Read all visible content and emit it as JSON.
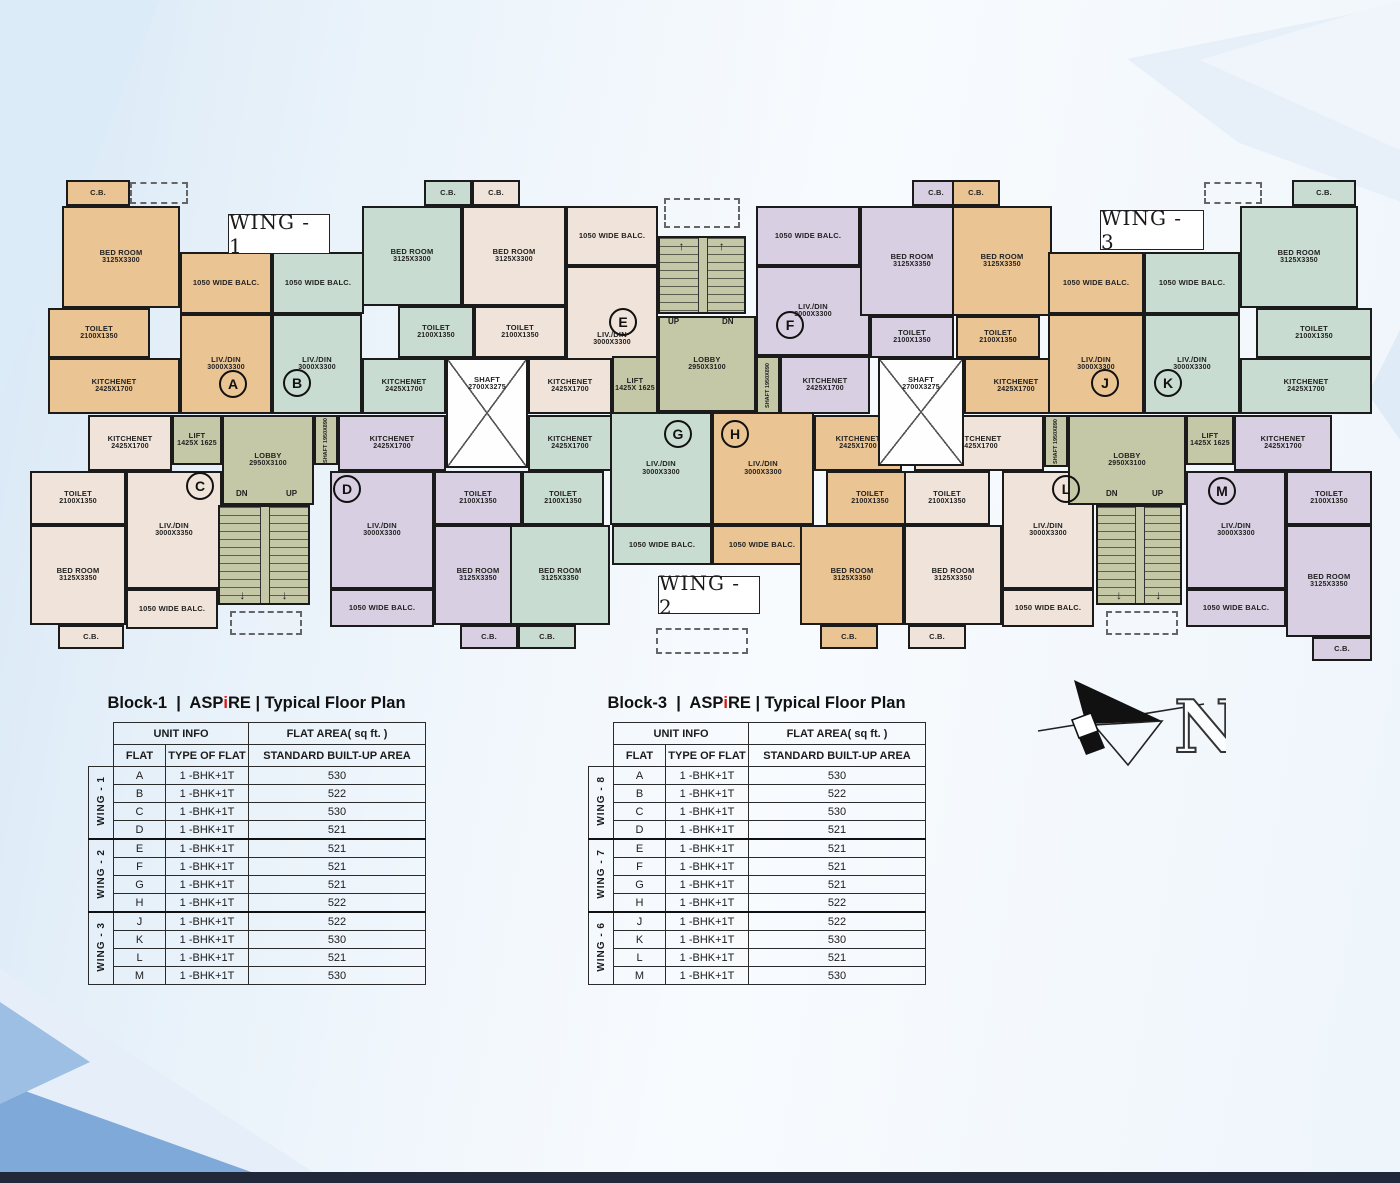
{
  "plan": {
    "wall_color": "#1b1b1b",
    "palette": {
      "tan": "#ebc493",
      "teal": "#c9dcd2",
      "cream": "#f0e3d9",
      "lav": "#d8d0e2",
      "core": "#c5c8a6",
      "shaft": "#fefefe"
    },
    "wings": [
      {
        "label": "WING - 1",
        "x": 228,
        "y": 214,
        "w": 102,
        "h": 40
      },
      {
        "label": "WING - 3",
        "x": 1100,
        "y": 210,
        "w": 104,
        "h": 40
      },
      {
        "label": "WING - 2",
        "x": 658,
        "y": 576,
        "w": 102,
        "h": 38
      }
    ],
    "rooms": [
      {
        "x": 66,
        "y": 180,
        "w": 64,
        "h": 26,
        "c": "tan",
        "n": "C.B.",
        "d": ""
      },
      {
        "x": 62,
        "y": 206,
        "w": 118,
        "h": 102,
        "c": "tan",
        "n": "BED ROOM",
        "d": "3125X3300"
      },
      {
        "x": 180,
        "y": 252,
        "w": 92,
        "h": 62,
        "c": "tan",
        "n": "1050 WIDE BALC.",
        "d": ""
      },
      {
        "x": 48,
        "y": 308,
        "w": 102,
        "h": 50,
        "c": "tan",
        "n": "TOILET",
        "d": "2100X1350"
      },
      {
        "x": 180,
        "y": 314,
        "w": 92,
        "h": 100,
        "c": "tan",
        "n": "LIV./DIN",
        "d": "3000X3300"
      },
      {
        "x": 48,
        "y": 358,
        "w": 132,
        "h": 56,
        "c": "tan",
        "n": "KITCHENET",
        "d": "2425X1700"
      },
      {
        "x": 272,
        "y": 252,
        "w": 92,
        "h": 62,
        "c": "teal",
        "n": "1050 WIDE BALC.",
        "d": ""
      },
      {
        "x": 272,
        "y": 314,
        "w": 90,
        "h": 100,
        "c": "teal",
        "n": "LIV./DIN",
        "d": "3000X3300"
      },
      {
        "x": 362,
        "y": 206,
        "w": 100,
        "h": 100,
        "c": "teal",
        "n": "BED ROOM",
        "d": "3125X3300"
      },
      {
        "x": 424,
        "y": 180,
        "w": 48,
        "h": 26,
        "c": "teal",
        "n": "C.B.",
        "d": ""
      },
      {
        "x": 398,
        "y": 306,
        "w": 76,
        "h": 52,
        "c": "teal",
        "n": "TOILET",
        "d": "2100X1350"
      },
      {
        "x": 362,
        "y": 358,
        "w": 84,
        "h": 56,
        "c": "teal",
        "n": "KITCHENET",
        "d": "2425X1700"
      },
      {
        "x": 472,
        "y": 180,
        "w": 48,
        "h": 26,
        "c": "cream",
        "n": "C.B.",
        "d": ""
      },
      {
        "x": 462,
        "y": 206,
        "w": 104,
        "h": 100,
        "c": "cream",
        "n": "BED ROOM",
        "d": "3125X3300"
      },
      {
        "x": 474,
        "y": 306,
        "w": 92,
        "h": 52,
        "c": "cream",
        "n": "TOILET",
        "d": "2100X1350"
      },
      {
        "x": 566,
        "y": 206,
        "w": 92,
        "h": 60,
        "c": "cream",
        "n": "1050 WIDE BALC.",
        "d": ""
      },
      {
        "x": 566,
        "y": 266,
        "w": 92,
        "h": 146,
        "c": "cream",
        "n": "LIV./DIN",
        "d": "3000X3300"
      },
      {
        "x": 528,
        "y": 358,
        "w": 84,
        "h": 56,
        "c": "cream",
        "n": "KITCHENET",
        "d": "2425X1700"
      },
      {
        "x": 612,
        "y": 356,
        "w": 46,
        "h": 58,
        "c": "core",
        "n": "LIFT",
        "d": "1425X 1625"
      },
      {
        "x": 658,
        "y": 316,
        "w": 98,
        "h": 96,
        "c": "core",
        "n": "LOBBY",
        "d": "2950X3100"
      },
      {
        "x": 756,
        "y": 206,
        "w": 104,
        "h": 60,
        "c": "lav",
        "n": "1050 WIDE BALC.",
        "d": ""
      },
      {
        "x": 756,
        "y": 266,
        "w": 114,
        "h": 90,
        "c": "lav",
        "n": "LIV./DIN",
        "d": "3000X3300"
      },
      {
        "x": 780,
        "y": 356,
        "w": 90,
        "h": 58,
        "c": "lav",
        "n": "KITCHENET",
        "d": "2425X1700"
      },
      {
        "x": 860,
        "y": 206,
        "w": 104,
        "h": 110,
        "c": "lav",
        "n": "BED ROOM",
        "d": "3125X3350"
      },
      {
        "x": 912,
        "y": 180,
        "w": 48,
        "h": 26,
        "c": "lav",
        "n": "C.B.",
        "d": ""
      },
      {
        "x": 870,
        "y": 316,
        "w": 84,
        "h": 42,
        "c": "lav",
        "n": "TOILET",
        "d": "2100X1350"
      },
      {
        "x": 952,
        "y": 180,
        "w": 48,
        "h": 26,
        "c": "tan",
        "n": "C.B.",
        "d": ""
      },
      {
        "x": 952,
        "y": 206,
        "w": 100,
        "h": 110,
        "c": "tan",
        "n": "BED ROOM",
        "d": "3125X3350"
      },
      {
        "x": 956,
        "y": 316,
        "w": 84,
        "h": 42,
        "c": "tan",
        "n": "TOILET",
        "d": "2100X1350"
      },
      {
        "x": 964,
        "y": 358,
        "w": 104,
        "h": 56,
        "c": "tan",
        "n": "KITCHENET",
        "d": "2425X1700"
      },
      {
        "x": 1048,
        "y": 252,
        "w": 96,
        "h": 62,
        "c": "tan",
        "n": "1050 WIDE BALC.",
        "d": ""
      },
      {
        "x": 1048,
        "y": 314,
        "w": 96,
        "h": 100,
        "c": "tan",
        "n": "LIV./DIN",
        "d": "3000X3300"
      },
      {
        "x": 1144,
        "y": 252,
        "w": 96,
        "h": 62,
        "c": "teal",
        "n": "1050 WIDE BALC.",
        "d": ""
      },
      {
        "x": 1144,
        "y": 314,
        "w": 96,
        "h": 100,
        "c": "teal",
        "n": "LIV./DIN",
        "d": "3000X3300"
      },
      {
        "x": 1240,
        "y": 206,
        "w": 118,
        "h": 102,
        "c": "teal",
        "n": "BED ROOM",
        "d": "3125X3350"
      },
      {
        "x": 1292,
        "y": 180,
        "w": 64,
        "h": 26,
        "c": "teal",
        "n": "C.B.",
        "d": ""
      },
      {
        "x": 1256,
        "y": 308,
        "w": 116,
        "h": 50,
        "c": "teal",
        "n": "TOILET",
        "d": "2100X1350"
      },
      {
        "x": 1240,
        "y": 358,
        "w": 132,
        "h": 56,
        "c": "teal",
        "n": "KITCHENET",
        "d": "2425X1700"
      },
      {
        "x": 88,
        "y": 415,
        "w": 84,
        "h": 56,
        "c": "cream",
        "n": "KITCHENET",
        "d": "2425X1700"
      },
      {
        "x": 172,
        "y": 415,
        "w": 50,
        "h": 50,
        "c": "core",
        "n": "LIFT",
        "d": "1425X 1625"
      },
      {
        "x": 222,
        "y": 415,
        "w": 92,
        "h": 90,
        "c": "core",
        "n": "LOBBY",
        "d": "2950X3100"
      },
      {
        "x": 30,
        "y": 471,
        "w": 96,
        "h": 54,
        "c": "cream",
        "n": "TOILET",
        "d": "2100X1350"
      },
      {
        "x": 126,
        "y": 471,
        "w": 96,
        "h": 118,
        "c": "cream",
        "n": "LIV./DIN",
        "d": "3000X3350"
      },
      {
        "x": 30,
        "y": 525,
        "w": 96,
        "h": 100,
        "c": "cream",
        "n": "BED ROOM",
        "d": "3125X3350"
      },
      {
        "x": 126,
        "y": 589,
        "w": 92,
        "h": 40,
        "c": "cream",
        "n": "1050 WIDE BALC.",
        "d": ""
      },
      {
        "x": 58,
        "y": 625,
        "w": 66,
        "h": 24,
        "c": "cream",
        "n": "C.B.",
        "d": ""
      },
      {
        "x": 338,
        "y": 415,
        "w": 108,
        "h": 56,
        "c": "lav",
        "n": "KITCHENET",
        "d": "2425X1700"
      },
      {
        "x": 330,
        "y": 471,
        "w": 104,
        "h": 118,
        "c": "lav",
        "n": "LIV./DIN",
        "d": "3000X3300"
      },
      {
        "x": 434,
        "y": 471,
        "w": 88,
        "h": 54,
        "c": "lav",
        "n": "TOILET",
        "d": "2100X1350"
      },
      {
        "x": 434,
        "y": 525,
        "w": 88,
        "h": 100,
        "c": "lav",
        "n": "BED ROOM",
        "d": "3125X3350"
      },
      {
        "x": 330,
        "y": 589,
        "w": 104,
        "h": 38,
        "c": "lav",
        "n": "1050 WIDE BALC.",
        "d": ""
      },
      {
        "x": 460,
        "y": 625,
        "w": 58,
        "h": 24,
        "c": "lav",
        "n": "C.B.",
        "d": ""
      },
      {
        "x": 528,
        "y": 415,
        "w": 84,
        "h": 56,
        "c": "teal",
        "n": "KITCHENET",
        "d": "2425X1700"
      },
      {
        "x": 522,
        "y": 471,
        "w": 82,
        "h": 54,
        "c": "teal",
        "n": "TOILET",
        "d": "2100X1350"
      },
      {
        "x": 510,
        "y": 525,
        "w": 100,
        "h": 100,
        "c": "teal",
        "n": "BED ROOM",
        "d": "3125X3350"
      },
      {
        "x": 518,
        "y": 625,
        "w": 58,
        "h": 24,
        "c": "teal",
        "n": "C.B.",
        "d": ""
      },
      {
        "x": 610,
        "y": 412,
        "w": 102,
        "h": 113,
        "c": "teal",
        "n": "LIV./DIN",
        "d": "3000X3300"
      },
      {
        "x": 612,
        "y": 525,
        "w": 100,
        "h": 40,
        "c": "teal",
        "n": "1050 WIDE BALC.",
        "d": ""
      },
      {
        "x": 712,
        "y": 412,
        "w": 102,
        "h": 113,
        "c": "tan",
        "n": "LIV./DIN",
        "d": "3000X3300"
      },
      {
        "x": 712,
        "y": 525,
        "w": 100,
        "h": 40,
        "c": "tan",
        "n": "1050 WIDE BALC.",
        "d": ""
      },
      {
        "x": 814,
        "y": 415,
        "w": 88,
        "h": 56,
        "c": "tan",
        "n": "KITCHENET",
        "d": "2425X1700"
      },
      {
        "x": 826,
        "y": 471,
        "w": 88,
        "h": 54,
        "c": "tan",
        "n": "TOILET",
        "d": "2100X1350"
      },
      {
        "x": 800,
        "y": 525,
        "w": 104,
        "h": 100,
        "c": "tan",
        "n": "BED ROOM",
        "d": "3125X3350"
      },
      {
        "x": 820,
        "y": 625,
        "w": 58,
        "h": 24,
        "c": "tan",
        "n": "C.B.",
        "d": ""
      },
      {
        "x": 914,
        "y": 415,
        "w": 130,
        "h": 56,
        "c": "cream",
        "n": "KITCHENET",
        "d": "2425X1700"
      },
      {
        "x": 904,
        "y": 471,
        "w": 86,
        "h": 54,
        "c": "cream",
        "n": "TOILET",
        "d": "2100X1350"
      },
      {
        "x": 904,
        "y": 525,
        "w": 98,
        "h": 100,
        "c": "cream",
        "n": "BED ROOM",
        "d": "3125X3350"
      },
      {
        "x": 908,
        "y": 625,
        "w": 58,
        "h": 24,
        "c": "cream",
        "n": "C.B.",
        "d": ""
      },
      {
        "x": 1002,
        "y": 471,
        "w": 92,
        "h": 118,
        "c": "cream",
        "n": "LIV./DIN",
        "d": "3000X3300"
      },
      {
        "x": 1002,
        "y": 589,
        "w": 92,
        "h": 38,
        "c": "cream",
        "n": "1050 WIDE BALC.",
        "d": ""
      },
      {
        "x": 1068,
        "y": 415,
        "w": 118,
        "h": 90,
        "c": "core",
        "n": "LOBBY",
        "d": "2950X3100"
      },
      {
        "x": 1186,
        "y": 415,
        "w": 48,
        "h": 50,
        "c": "core",
        "n": "LIFT",
        "d": "1425X 1625"
      },
      {
        "x": 1234,
        "y": 415,
        "w": 98,
        "h": 56,
        "c": "lav",
        "n": "KITCHENET",
        "d": "2425X1700"
      },
      {
        "x": 1186,
        "y": 471,
        "w": 100,
        "h": 118,
        "c": "lav",
        "n": "LIV./DIN",
        "d": "3000X3300"
      },
      {
        "x": 1186,
        "y": 589,
        "w": 100,
        "h": 38,
        "c": "lav",
        "n": "1050 WIDE BALC.",
        "d": ""
      },
      {
        "x": 1286,
        "y": 471,
        "w": 86,
        "h": 54,
        "c": "lav",
        "n": "TOILET",
        "d": "2100X1350"
      },
      {
        "x": 1286,
        "y": 525,
        "w": 86,
        "h": 112,
        "c": "lav",
        "n": "BED ROOM",
        "d": "3125X3350"
      },
      {
        "x": 1312,
        "y": 637,
        "w": 60,
        "h": 24,
        "c": "lav",
        "n": "C.B.",
        "d": ""
      }
    ],
    "shafts": [
      {
        "x": 446,
        "y": 358,
        "w": 82,
        "h": 110,
        "n": "SHAFT",
        "d": "2700X3275"
      },
      {
        "x": 878,
        "y": 358,
        "w": 86,
        "h": 108,
        "n": "SHAFT",
        "d": "2700X3275"
      }
    ],
    "vshafts": [
      {
        "x": 756,
        "y": 356,
        "w": 24,
        "h": 58,
        "t": "SHAFT 1950X890"
      },
      {
        "x": 314,
        "y": 415,
        "w": 24,
        "h": 50,
        "t": "SHAFT 1950X890"
      },
      {
        "x": 1044,
        "y": 415,
        "w": 24,
        "h": 52,
        "t": "SHAFT 1950X890"
      }
    ],
    "stairs": [
      {
        "x": 658,
        "y": 236,
        "w": 88,
        "h": 78,
        "arrow": "↑",
        "apos": "top"
      },
      {
        "x": 218,
        "y": 505,
        "w": 92,
        "h": 100,
        "arrow": "↓",
        "apos": "bottom"
      },
      {
        "x": 1096,
        "y": 505,
        "w": 86,
        "h": 100,
        "arrow": "↓",
        "apos": "bottom"
      }
    ],
    "texts": [
      {
        "t": "UP",
        "x": 668,
        "y": 317
      },
      {
        "t": "DN",
        "x": 722,
        "y": 317
      },
      {
        "t": "DN",
        "x": 236,
        "y": 489
      },
      {
        "t": "UP",
        "x": 286,
        "y": 489
      },
      {
        "t": "DN",
        "x": 1106,
        "y": 489
      },
      {
        "t": "UP",
        "x": 1152,
        "y": 489
      }
    ],
    "circles": [
      {
        "t": "A",
        "x": 233,
        "y": 384
      },
      {
        "t": "B",
        "x": 297,
        "y": 383
      },
      {
        "t": "C",
        "x": 200,
        "y": 486
      },
      {
        "t": "D",
        "x": 347,
        "y": 489
      },
      {
        "t": "E",
        "x": 623,
        "y": 322
      },
      {
        "t": "F",
        "x": 790,
        "y": 325
      },
      {
        "t": "G",
        "x": 678,
        "y": 434
      },
      {
        "t": "H",
        "x": 735,
        "y": 434
      },
      {
        "t": "J",
        "x": 1105,
        "y": 383
      },
      {
        "t": "K",
        "x": 1168,
        "y": 383
      },
      {
        "t": "L",
        "x": 1066,
        "y": 489
      },
      {
        "t": "M",
        "x": 1222,
        "y": 491
      }
    ],
    "dashed": [
      {
        "x": 656,
        "y": 628,
        "w": 92,
        "h": 26
      },
      {
        "x": 230,
        "y": 611,
        "w": 72,
        "h": 24
      },
      {
        "x": 1106,
        "y": 611,
        "w": 72,
        "h": 24
      },
      {
        "x": 664,
        "y": 198,
        "w": 76,
        "h": 30
      },
      {
        "x": 130,
        "y": 182,
        "w": 58,
        "h": 22
      },
      {
        "x": 1204,
        "y": 182,
        "w": 58,
        "h": 22
      }
    ],
    "compass": {
      "n": "N"
    }
  },
  "tables": [
    {
      "x": 88,
      "y": 694,
      "title": {
        "pre": "Block-1  |  ASP",
        "accent": "i",
        "post": "RE | Typical Floor Plan"
      },
      "header": {
        "group1": "UNIT INFO",
        "group2": "FLAT AREA( sq ft. )",
        "c1": "FLAT",
        "c2": "TYPE OF FLAT",
        "c3": "STANDARD BUILT-UP AREA"
      },
      "groups": [
        {
          "wing": "WING - 1",
          "rows": [
            [
              "A",
              "1 -BHK+1T",
              "530"
            ],
            [
              "B",
              "1 -BHK+1T",
              "522"
            ],
            [
              "C",
              "1 -BHK+1T",
              "530"
            ],
            [
              "D",
              "1 -BHK+1T",
              "521"
            ]
          ]
        },
        {
          "wing": "WING - 2",
          "rows": [
            [
              "E",
              "1 -BHK+1T",
              "521"
            ],
            [
              "F",
              "1 -BHK+1T",
              "521"
            ],
            [
              "G",
              "1 -BHK+1T",
              "521"
            ],
            [
              "H",
              "1 -BHK+1T",
              "522"
            ]
          ]
        },
        {
          "wing": "WING - 3",
          "rows": [
            [
              "J",
              "1 -BHK+1T",
              "522"
            ],
            [
              "K",
              "1 -BHK+1T",
              "530"
            ],
            [
              "L",
              "1 -BHK+1T",
              "521"
            ],
            [
              "M",
              "1 -BHK+1T",
              "530"
            ]
          ]
        }
      ]
    },
    {
      "x": 588,
      "y": 694,
      "title": {
        "pre": "Block-3  |  ASP",
        "accent": "i",
        "post": "RE | Typical Floor Plan"
      },
      "header": {
        "group1": "UNIT INFO",
        "group2": "FLAT AREA( sq ft. )",
        "c1": "FLAT",
        "c2": "TYPE OF FLAT",
        "c3": "STANDARD BUILT-UP AREA"
      },
      "groups": [
        {
          "wing": "WING - 8",
          "rows": [
            [
              "A",
              "1 -BHK+1T",
              "530"
            ],
            [
              "B",
              "1 -BHK+1T",
              "522"
            ],
            [
              "C",
              "1 -BHK+1T",
              "530"
            ],
            [
              "D",
              "1 -BHK+1T",
              "521"
            ]
          ]
        },
        {
          "wing": "WING - 7",
          "rows": [
            [
              "E",
              "1 -BHK+1T",
              "521"
            ],
            [
              "F",
              "1 -BHK+1T",
              "521"
            ],
            [
              "G",
              "1 -BHK+1T",
              "521"
            ],
            [
              "H",
              "1 -BHK+1T",
              "522"
            ]
          ]
        },
        {
          "wing": "WING - 6",
          "rows": [
            [
              "J",
              "1 -BHK+1T",
              "522"
            ],
            [
              "K",
              "1 -BHK+1T",
              "530"
            ],
            [
              "L",
              "1 -BHK+1T",
              "521"
            ],
            [
              "M",
              "1 -BHK+1T",
              "530"
            ]
          ]
        }
      ]
    }
  ]
}
